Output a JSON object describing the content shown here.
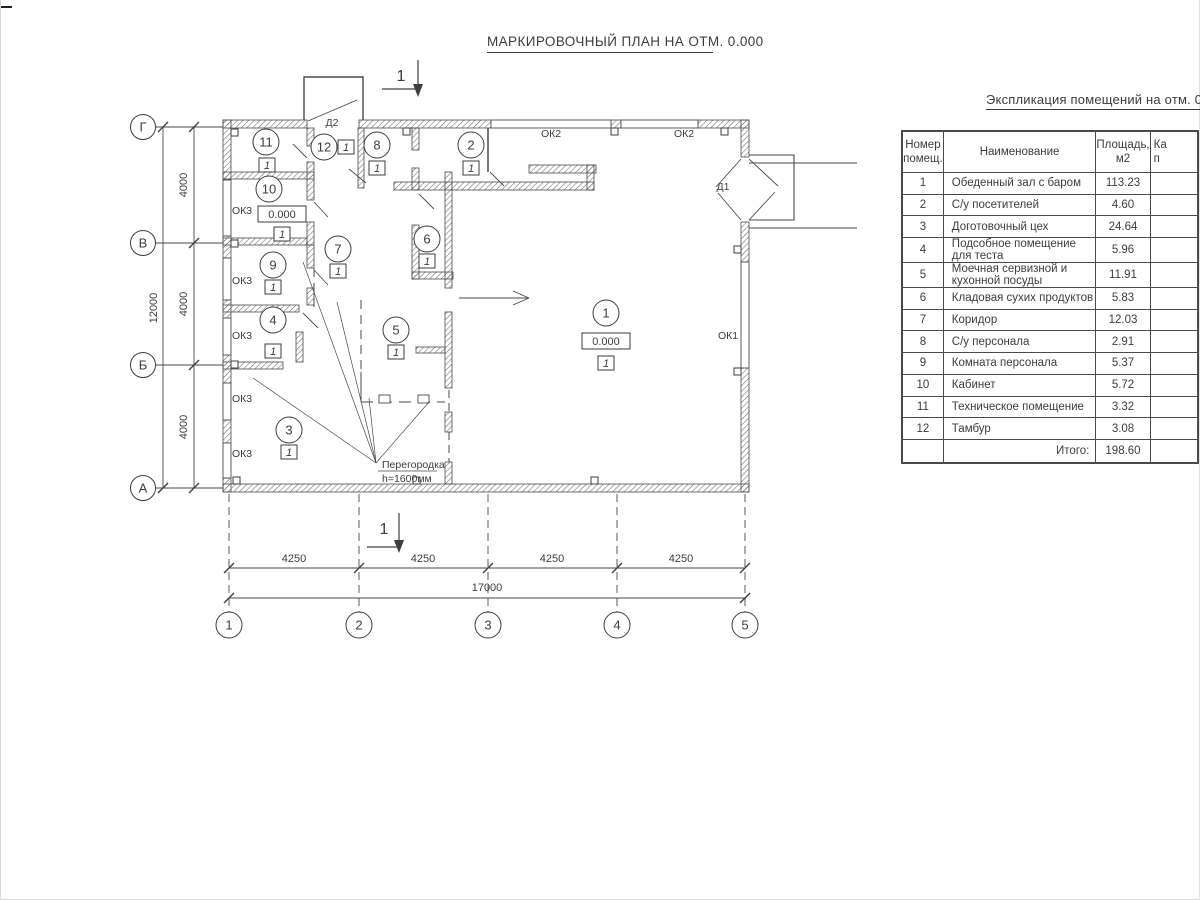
{
  "title": "МАРКИРОВОЧНЫЙ ПЛАН НА ОТМ. 0.000",
  "plan": {
    "section_label": "1",
    "elevation_mark": "0.000",
    "category_mark": "1",
    "axes_rows": [
      "Г",
      "В",
      "Б",
      "А"
    ],
    "axes_cols": [
      "1",
      "2",
      "3",
      "4",
      "5"
    ],
    "dims_left": {
      "segments": [
        "4000",
        "4000",
        "4000"
      ],
      "total": "12000"
    },
    "dims_bottom": {
      "segments": [
        "4250",
        "4250",
        "4250",
        "4250"
      ],
      "total": "17000"
    },
    "labels": {
      "window1": "ОК1",
      "window2": "ОК2",
      "window3": "ОК3",
      "door1": "Д1",
      "door2": "Д2"
    },
    "rooms": [
      {
        "num": "1",
        "has_elevation": true
      },
      {
        "num": "2"
      },
      {
        "num": "3"
      },
      {
        "num": "4"
      },
      {
        "num": "5"
      },
      {
        "num": "6"
      },
      {
        "num": "7"
      },
      {
        "num": "8"
      },
      {
        "num": "9"
      },
      {
        "num": "10",
        "has_elevation": true
      },
      {
        "num": "11"
      },
      {
        "num": "12"
      }
    ],
    "partition_note": {
      "line1": "Перегородка",
      "line2": "h=1600мм"
    }
  },
  "schedule": {
    "title": "Экспликация помещений на отм. 0.000",
    "headers": {
      "col1": [
        "Номер",
        "помещ."
      ],
      "col2": "Наименование",
      "col3": [
        "Площадь,",
        "м2"
      ],
      "col4": [
        "Ка",
        "п"
      ]
    },
    "rows": [
      {
        "num": "1",
        "name": "Обеденный зал с баром",
        "area": "113.23"
      },
      {
        "num": "2",
        "name": "С/у посетителей",
        "area": "4.60"
      },
      {
        "num": "3",
        "name": "Доготовочный цех",
        "area": "24.64"
      },
      {
        "num": "4",
        "name": "Подсобное помещение для теста",
        "area": "5.96"
      },
      {
        "num": "5",
        "name": "Моечная сервизной и кухонной посуды",
        "area": "11.91"
      },
      {
        "num": "6",
        "name": "Кладовая сухих продуктов",
        "area": "5.83"
      },
      {
        "num": "7",
        "name": "Коридор",
        "area": "12.03"
      },
      {
        "num": "8",
        "name": "С/у персонала",
        "area": "2.91"
      },
      {
        "num": "9",
        "name": "Комната персонала",
        "area": "5.37"
      },
      {
        "num": "10",
        "name": "Кабинет",
        "area": "5.72"
      },
      {
        "num": "11",
        "name": "Техническое помещение",
        "area": "3.32"
      },
      {
        "num": "12",
        "name": "Тамбур",
        "area": "3.08"
      }
    ],
    "total_label": "Итого:",
    "total_area": "198.60"
  },
  "colors": {
    "ink": "#3d3d3d",
    "line": "#4a4a4a",
    "background": "#ffffff"
  }
}
